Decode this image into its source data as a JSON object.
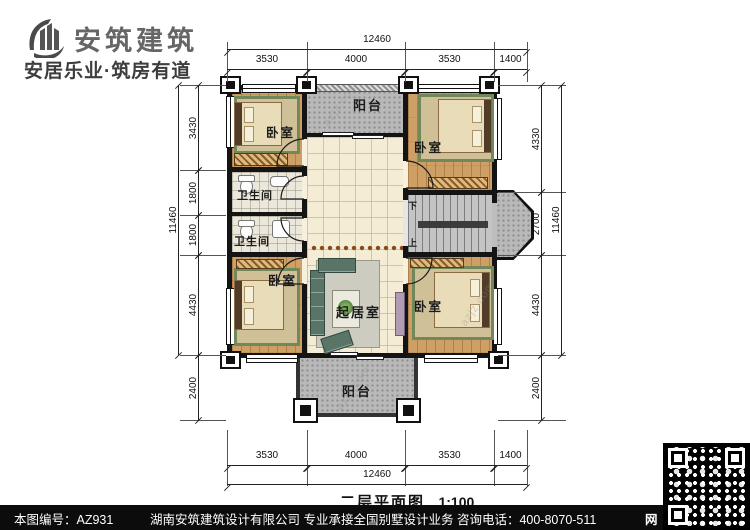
{
  "header": {
    "logo_text": "安筑建筑",
    "tagline": "安居乐业·筑房有道"
  },
  "rooms": {
    "balcony_top": "阳台",
    "bedroom_tl": "卧室",
    "bedroom_tr": "卧室",
    "bathroom_1": "卫生间",
    "bathroom_2": "卫生间",
    "bedroom_bl": "卧室",
    "bedroom_br": "卧室",
    "living": "起居室",
    "balcony_bottom": "阳台",
    "stair_down": "下",
    "stair_up": "上"
  },
  "dims": {
    "top_total": "12460",
    "top_segments": [
      "3530",
      "4000",
      "3530",
      "1400"
    ],
    "bottom_segments": [
      "3530",
      "4000",
      "3530",
      "1400"
    ],
    "bottom_total": "12460",
    "left_total": "11460",
    "left_segments": [
      "3430",
      "1800",
      "1800",
      "4430",
      "2400"
    ],
    "right_total": "11460",
    "right_segments": [
      "4330",
      "2700",
      "4430",
      "2400"
    ]
  },
  "title": {
    "text": "二层平面图",
    "scale": "1:100"
  },
  "footer": {
    "drawing_no": "本图编号：AZ931",
    "company_info": "湖南安筑建筑设计有限公司  专业承接全国别墅设计业务  咨询电话：400-8070-511",
    "web_char": "网"
  },
  "watermark": "azjz.com",
  "colors": {
    "wall": "#141414",
    "wood_floor": "#cfa065",
    "hall_tile": "#f5ecd6",
    "concrete": "#b9b9b9",
    "rug_green": "#72875a",
    "footer_bg": "#0c0c0c"
  }
}
